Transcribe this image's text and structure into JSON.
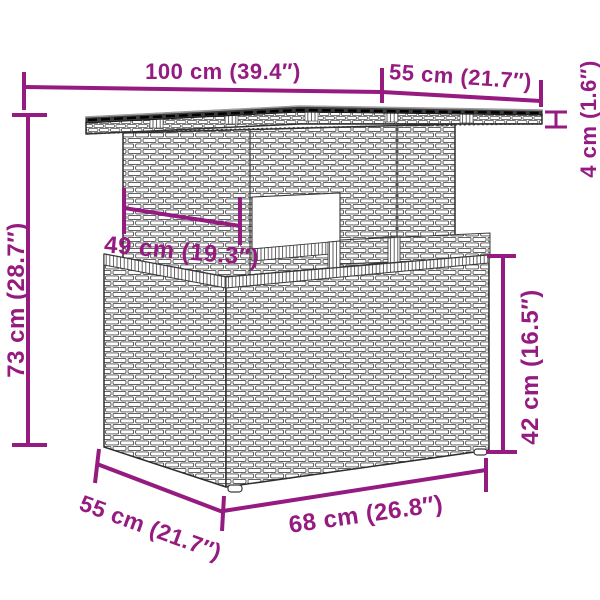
{
  "accent_color": "#951b81",
  "line_color": "#3a3a3a",
  "glass_color": "#3c3c3c",
  "dims": {
    "top_length": {
      "label": "100 cm (39.4″)"
    },
    "top_depth": {
      "label": "55 cm (21.7″)"
    },
    "top_thickness": {
      "label": "4 cm (1.6″)"
    },
    "overall_height": {
      "label": "73 cm (28.7″)"
    },
    "pedestal_width": {
      "label": "49 cm (19.3″)"
    },
    "base_height": {
      "label": "42 cm (16.5″)"
    },
    "base_depth": {
      "label": "55 cm (21.7″)"
    },
    "base_length": {
      "label": "68 cm (26.8″)"
    }
  }
}
